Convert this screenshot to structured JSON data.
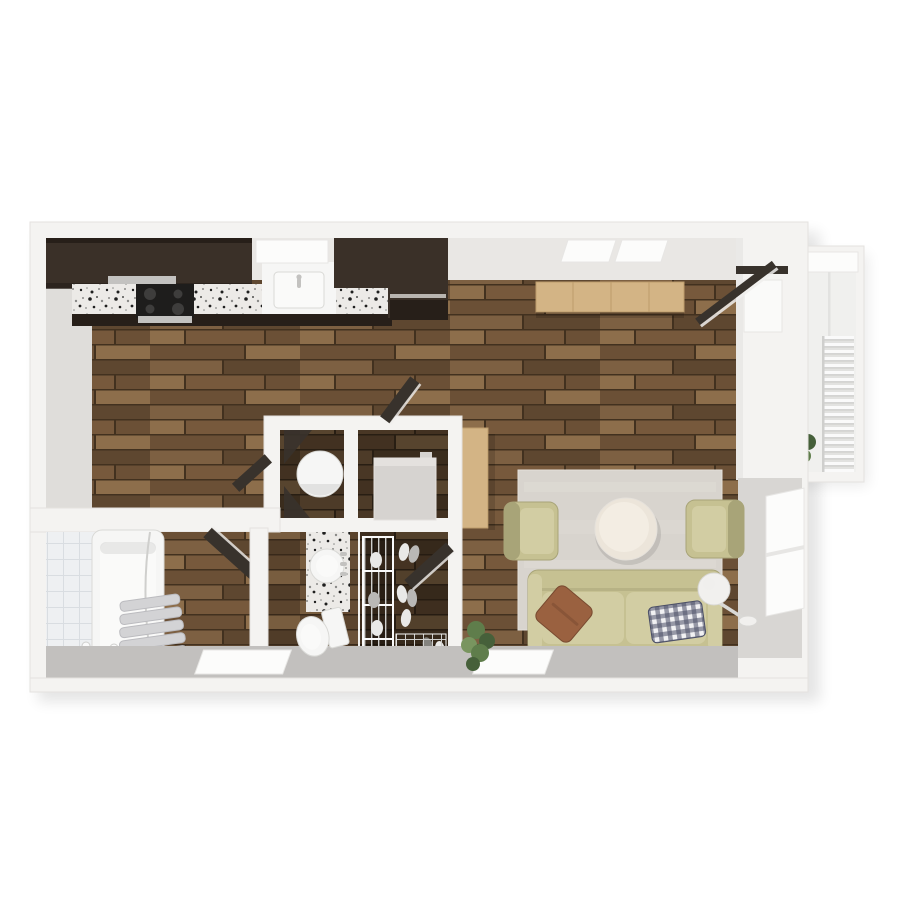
{
  "meta": {
    "kind": "3d-floorplan-render",
    "description": "Top-down 3D rendering of a studio apartment floor plan, no visible text",
    "canvas": {
      "width": 900,
      "height": 900
    }
  },
  "palette": {
    "bg": "#ffffff",
    "wallOuter": "#f4f3f1",
    "wallStroke": "#e4e2df",
    "wallFaceTop": "#e9e7e4",
    "wallFaceLeft": "#dfddda",
    "wallFaceRight": "#d8d6d3",
    "wallFaceBottom": "#c2c0be",
    "shadow": "#000000",
    "windowWhite": "#fcfcfb",
    "windowFrame": "#e7e6e4",
    "glassPane": "#fafaf9",
    "cabinetDark": "#3a3028",
    "cabinetDarker": "#271f19",
    "steel": "#c3c2c0",
    "cooktopBlack": "#1e1d1c",
    "burner": "#3e3d3c",
    "graniteBase": "#eceae7",
    "graniteDot1": "#1f1f1f",
    "graniteDot2": "#8a8a88",
    "oak": "#d3b485",
    "oakDark": "#bd9c6c",
    "woodA": "#7d6042",
    "woodB": "#6b5036",
    "woodC": "#8d6e4b",
    "woodD": "#5e4730",
    "woodE": "#77593c",
    "woodGap": "#42311f",
    "rug": "#d8d4ce",
    "rugLight": "#e5e1db",
    "tableCream": "#ece5da",
    "tableCreamLight": "#f3ede3",
    "sofa": "#c6c192",
    "sofaCushion": "#d2cda3",
    "sofaDark": "#a8a478",
    "sofaShadow": "#807d5e",
    "pillowBrown": "#9a6140",
    "pillowBrownDark": "#784a30",
    "checkBase": "#f1f1f3",
    "checkNavy": "#4b4f66",
    "lampWhite": "#f1f0ee",
    "lampGray": "#d9d8d5",
    "plantGreen": "#5f7d4b",
    "plantGreenDark": "#46603a",
    "plantGreenLight": "#79955f",
    "porcelain": "#f6f6f5",
    "porcelainShade": "#d9d9d6",
    "tileBase": "#eef0f2",
    "tileLine": "#d9dde1",
    "curtainGray": "#d3d3d5",
    "curtainEdge": "#bbbbbf",
    "doorDark": "#38322c",
    "doorEdge": "#f0efed",
    "balconyFloor": "#f0f0ee",
    "railBase": "#e2e2e0",
    "railSlat": "#fafafa",
    "wire": "#cfcfcd",
    "applianceGray": "#d6d3d0",
    "applianceGrayLight": "#e4e1de",
    "shoeLight": "#e9e9e7",
    "shoeMid": "#b9b8b6",
    "shoeDark": "#84837f"
  },
  "inventory": {
    "rooms": [
      {
        "name": "kitchen",
        "items": [
          "upper-cabinets",
          "granite-countertop",
          "cooktop",
          "oven",
          "sink",
          "tall-cabinet",
          "window"
        ]
      },
      {
        "name": "living-room",
        "items": [
          "rug",
          "sofa",
          "armchair-left",
          "armchair-right",
          "round-coffee-table",
          "floor-lamp",
          "sideboard",
          "console-desk",
          "floor-plant",
          "windows"
        ]
      },
      {
        "name": "bathroom",
        "items": [
          "bathtub",
          "shower-curtain",
          "faucet",
          "tiled-wall",
          "door"
        ]
      },
      {
        "name": "vanity-nook",
        "items": [
          "granite-counter",
          "round-sink",
          "toilet"
        ]
      },
      {
        "name": "utility-room-left",
        "items": [
          "water-heater-cylinder",
          "door"
        ]
      },
      {
        "name": "utility-room-right",
        "items": [
          "appliance-box",
          "door"
        ]
      },
      {
        "name": "closet",
        "items": [
          "wire-shelving",
          "wire-basket",
          "shoes",
          "door"
        ]
      },
      {
        "name": "balcony",
        "items": [
          "railing",
          "plant",
          "sliding-glass-door",
          "concrete-floor"
        ]
      }
    ],
    "window_count": 5,
    "door_leaf_count": 5
  }
}
